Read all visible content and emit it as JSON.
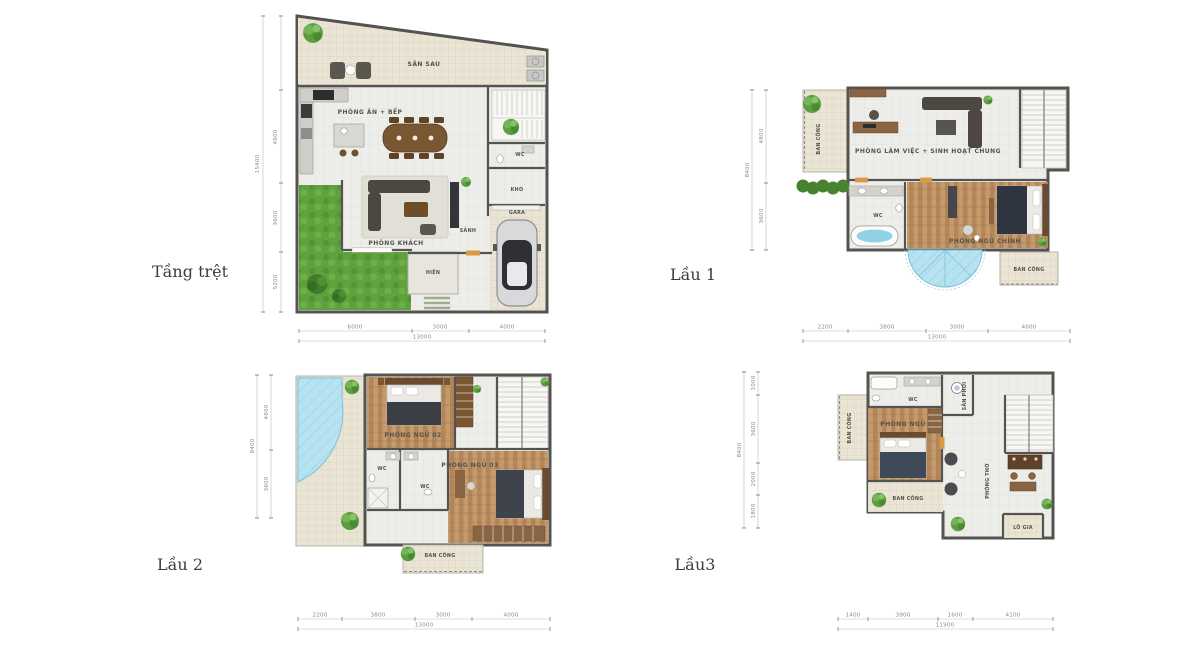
{
  "titles": {
    "ground": "Tầng trệt",
    "f1": "Lầu 1",
    "f2": "Lầu 2",
    "f3": "Lầu3"
  },
  "ground": {
    "rooms": {
      "san_sau": "SÂN SAU",
      "an_bep": "PHÒNG ĂN + BẾP",
      "khach": "PHÒNG KHÁCH",
      "sanh": "SẢNH",
      "wc": "WC",
      "kho": "KHO",
      "gara": "GARA",
      "hien": "HIÊN"
    },
    "dims": {
      "b1": "6000",
      "b2": "3000",
      "b3": "4000",
      "btotal": "13000",
      "l1": "4600",
      "l2": "3600",
      "l3": "5200",
      "ltotal": "15400"
    }
  },
  "f1": {
    "rooms": {
      "balcony_left": "BAN CÔNG",
      "main": "PHÒNG LÀM VIỆC + SINH HOẠT CHUNG",
      "wc": "WC",
      "master": "PHÒNG NGỦ CHÍNH",
      "balcony_right": "BAN CÔNG"
    },
    "dims": {
      "b1": "2200",
      "b2": "3800",
      "b3": "3000",
      "b4": "4000",
      "btotal": "13000",
      "l1": "4800",
      "l2": "3600",
      "ltotal": "8400"
    }
  },
  "f2": {
    "rooms": {
      "bed2": "PHÒNG NGỦ 02",
      "bed3": "PHÒNG NGỦ 03",
      "wc1": "WC",
      "wc2": "WC",
      "balcony": "BAN CÔNG"
    },
    "dims": {
      "b1": "2200",
      "b2": "3800",
      "b3": "3000",
      "b4": "4000",
      "btotal": "13000",
      "l1": "4800",
      "l2": "3600",
      "ltotal": "8400"
    }
  },
  "f3": {
    "rooms": {
      "balcony_left": "BAN CÔNG",
      "wc": "WC",
      "bed": "PHÒNG NGỦ",
      "san_phoi": "SÂN PHƠI",
      "tho": "PHÒNG THỜ",
      "balcony_bottom": "BAN CÔNG",
      "lo_gia": "LÔ GIA"
    },
    "dims": {
      "b1": "1400",
      "b2": "3900",
      "b3": "1600",
      "b4": "4100",
      "btotal": "11900",
      "l1": "1000",
      "l2": "3600",
      "l3": "2000",
      "l4": "1800",
      "ltotal": "8400"
    }
  }
}
